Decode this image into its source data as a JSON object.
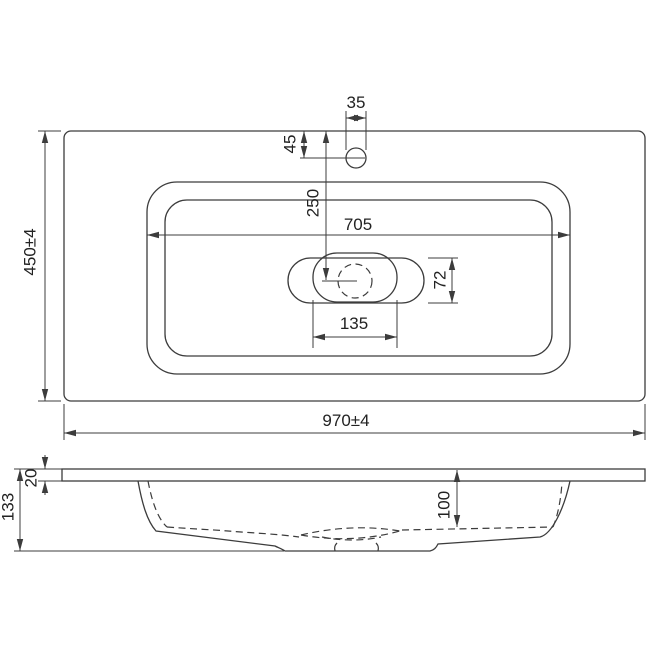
{
  "document": {
    "type": "technical-dimension-drawing",
    "subject": "vanity-washbasin",
    "background": "#ffffff",
    "line_color": "#3c3c3c",
    "text_color": "#222222",
    "views": [
      "top-view",
      "side-section-view"
    ]
  },
  "top_view": {
    "dims": {
      "faucet_hole_diameter": "35",
      "faucet_hole_from_front_edge": "45",
      "drain_center_from_front_edge": "250",
      "bowl_opening_width": "705",
      "drain_recess_height": "72",
      "drain_recess_width": "135",
      "overall_width": "970±4",
      "overall_depth": "450±4"
    }
  },
  "side_view": {
    "dims": {
      "countertop_thickness": "20",
      "overall_height": "133",
      "bowl_inner_depth": "100"
    }
  }
}
